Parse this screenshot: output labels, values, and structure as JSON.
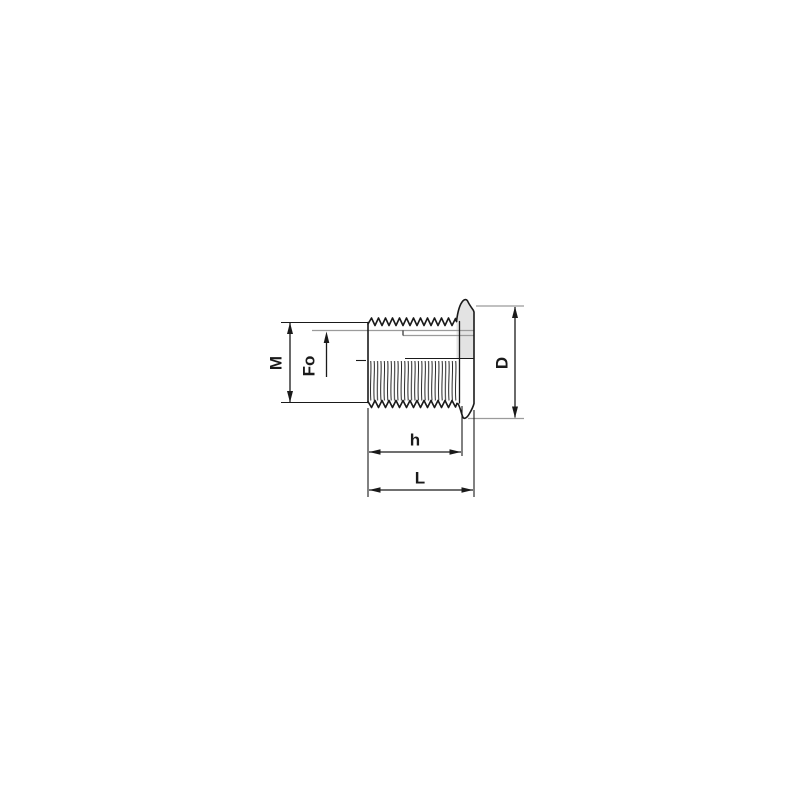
{
  "drawing": {
    "colors": {
      "line": "#1a1a1a",
      "extension_line": "#9b9b9b",
      "flange_fill": "#e3e3e3"
    },
    "labels": {
      "thread_diameter": "M",
      "bore_depth": "Fo",
      "flange_diameter": "D",
      "body_length": "h",
      "overall_length": "L"
    }
  }
}
